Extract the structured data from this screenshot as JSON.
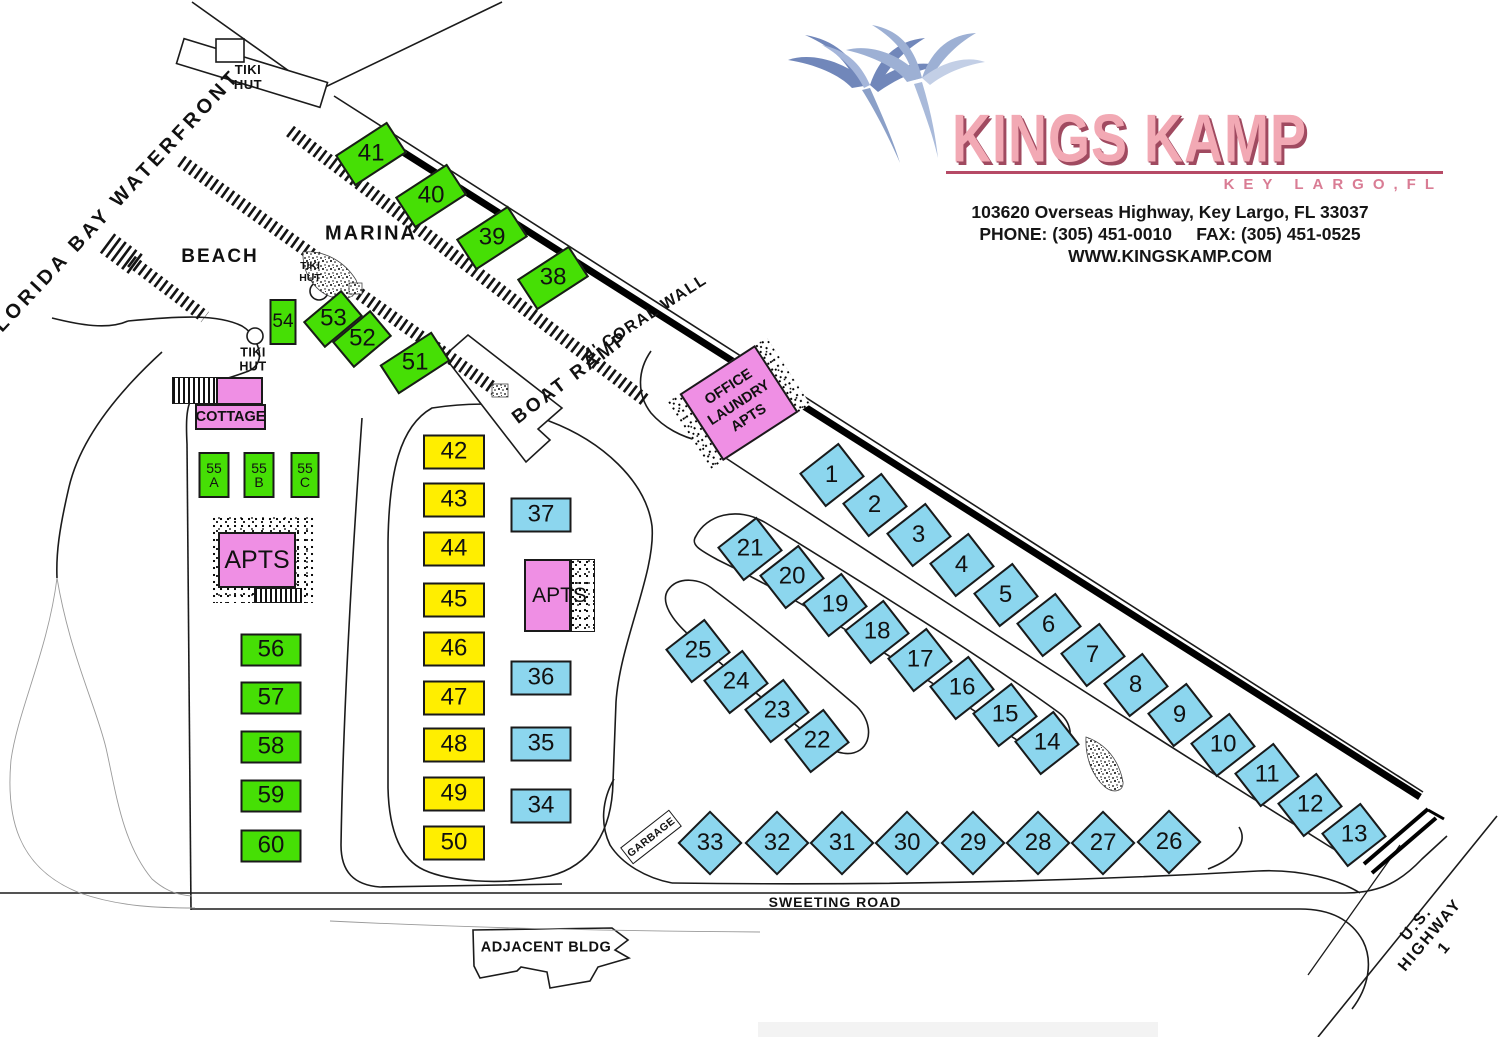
{
  "header": {
    "brand": "KINGS KAMP",
    "tagline": "KEY LARGO,FL",
    "address": "103620 Overseas Highway, Key Largo, FL 33037",
    "phone": "PHONE: (305) 451-0010",
    "fax": "FAX: (305) 451-0525",
    "website": "WWW.KINGSKAMP.COM"
  },
  "colors": {
    "site_green": "#46df05",
    "site_yellow": "#ffee00",
    "site_blue": "#8cd6ee",
    "building_pink": "#ef8fe4",
    "brand_pink": "#f2a9b4",
    "brand_shadow": "#a04a60"
  },
  "buildings": {
    "cottage": {
      "label": "COTTAGE"
    },
    "apartments_west": {
      "label": "APTS"
    },
    "apartments_center": {
      "label": "APTS"
    },
    "office": {
      "lines": [
        "OFFICE",
        "LAUNDRY",
        "APTS"
      ]
    },
    "garbage": {
      "label": "GARBAGE"
    }
  },
  "map": {
    "labels": [
      {
        "id": "florida-bay-waterfront",
        "text": "FLORIDA BAY WATERFRONT",
        "x": 112,
        "y": 207,
        "r": -47,
        "fs": 20,
        "ls": 4
      },
      {
        "id": "tiki-hut-north",
        "text": "TIKI\nHUT",
        "x": 248,
        "y": 78,
        "fs": 13,
        "ls": 0.5
      },
      {
        "id": "marina",
        "text": "MARINA",
        "x": 371,
        "y": 234,
        "fs": 20,
        "ls": 2
      },
      {
        "id": "beach",
        "text": "BEACH",
        "x": 220,
        "y": 257,
        "fs": 19,
        "ls": 2
      },
      {
        "id": "tiki-hut-marina",
        "text": "TIKI\nHUT",
        "x": 310,
        "y": 272,
        "fs": 10.5,
        "ls": 0
      },
      {
        "id": "tiki-hut-beach",
        "text": "TIKI\nHUT",
        "x": 253,
        "y": 360,
        "fs": 12.5,
        "ls": 0.5
      },
      {
        "id": "coral-wall",
        "text": "4' CORAL WALL",
        "x": 646,
        "y": 318,
        "r": -33,
        "fs": 16,
        "ls": 1.5
      },
      {
        "id": "boat-ramp",
        "text": "BOAT RAMP",
        "x": 571,
        "y": 378,
        "r": -37,
        "fs": 19,
        "ls": 3
      },
      {
        "id": "sweeting-road",
        "text": "SWEETING ROAD",
        "x": 835,
        "y": 902,
        "fs": 14,
        "ls": 1
      },
      {
        "id": "adjacent-bldg",
        "text": "ADJACENT BLDG",
        "x": 546,
        "y": 948,
        "fs": 14.5,
        "ls": 0.5
      },
      {
        "id": "us-highway-1",
        "text": "U.S. HIGHWAY 1",
        "x": 1431,
        "y": 936,
        "r": -50,
        "fs": 16,
        "ls": 2
      }
    ],
    "sites": [
      {
        "l": "1",
        "x": 832,
        "y": 475,
        "w": 50,
        "h": 43,
        "r": -38,
        "c": "blue"
      },
      {
        "l": "2",
        "x": 875,
        "y": 505,
        "w": 50,
        "h": 43,
        "r": -38,
        "c": "blue"
      },
      {
        "l": "3",
        "x": 919,
        "y": 535,
        "w": 50,
        "h": 43,
        "r": -38,
        "c": "blue"
      },
      {
        "l": "4",
        "x": 962,
        "y": 565,
        "w": 50,
        "h": 43,
        "r": -38,
        "c": "blue"
      },
      {
        "l": "5",
        "x": 1006,
        "y": 595,
        "w": 50,
        "h": 43,
        "r": -38,
        "c": "blue"
      },
      {
        "l": "6",
        "x": 1049,
        "y": 625,
        "w": 50,
        "h": 43,
        "r": -38,
        "c": "blue"
      },
      {
        "l": "7",
        "x": 1093,
        "y": 655,
        "w": 50,
        "h": 43,
        "r": -38,
        "c": "blue"
      },
      {
        "l": "8",
        "x": 1136,
        "y": 685,
        "w": 50,
        "h": 43,
        "r": -38,
        "c": "blue"
      },
      {
        "l": "9",
        "x": 1180,
        "y": 715,
        "w": 50,
        "h": 43,
        "r": -38,
        "c": "blue"
      },
      {
        "l": "10",
        "x": 1223,
        "y": 745,
        "w": 50,
        "h": 43,
        "r": -38,
        "c": "blue"
      },
      {
        "l": "11",
        "x": 1267,
        "y": 775,
        "w": 50,
        "h": 43,
        "r": -38,
        "c": "blue"
      },
      {
        "l": "12",
        "x": 1310,
        "y": 805,
        "w": 50,
        "h": 43,
        "r": -38,
        "c": "blue"
      },
      {
        "l": "13",
        "x": 1354,
        "y": 835,
        "w": 50,
        "h": 43,
        "r": -38,
        "c": "blue"
      },
      {
        "l": "14",
        "x": 1047,
        "y": 743,
        "w": 50,
        "h": 43,
        "r": -38,
        "c": "blue"
      },
      {
        "l": "15",
        "x": 1005,
        "y": 715,
        "w": 50,
        "h": 43,
        "r": -38,
        "c": "blue"
      },
      {
        "l": "16",
        "x": 962,
        "y": 688,
        "w": 50,
        "h": 43,
        "r": -38,
        "c": "blue"
      },
      {
        "l": "17",
        "x": 920,
        "y": 660,
        "w": 50,
        "h": 43,
        "r": -38,
        "c": "blue"
      },
      {
        "l": "18",
        "x": 877,
        "y": 632,
        "w": 50,
        "h": 43,
        "r": -38,
        "c": "blue"
      },
      {
        "l": "19",
        "x": 835,
        "y": 605,
        "w": 50,
        "h": 43,
        "r": -38,
        "c": "blue"
      },
      {
        "l": "20",
        "x": 792,
        "y": 577,
        "w": 50,
        "h": 43,
        "r": -38,
        "c": "blue"
      },
      {
        "l": "21",
        "x": 750,
        "y": 549,
        "w": 50,
        "h": 43,
        "r": -38,
        "c": "blue"
      },
      {
        "l": "22",
        "x": 817,
        "y": 741,
        "w": 50,
        "h": 43,
        "r": -38,
        "c": "blue"
      },
      {
        "l": "23",
        "x": 777,
        "y": 711,
        "w": 50,
        "h": 43,
        "r": -38,
        "c": "blue"
      },
      {
        "l": "24",
        "x": 736,
        "y": 682,
        "w": 50,
        "h": 43,
        "r": -38,
        "c": "blue"
      },
      {
        "l": "25",
        "x": 698,
        "y": 651,
        "w": 50,
        "h": 43,
        "r": -38,
        "c": "blue"
      },
      {
        "l": "26",
        "x": 1169,
        "y": 842,
        "w": 46,
        "h": 46,
        "r": 45,
        "c": "blue"
      },
      {
        "l": "27",
        "x": 1103,
        "y": 843,
        "w": 46,
        "h": 46,
        "r": 45,
        "c": "blue"
      },
      {
        "l": "28",
        "x": 1038,
        "y": 843,
        "w": 46,
        "h": 46,
        "r": 45,
        "c": "blue"
      },
      {
        "l": "29",
        "x": 973,
        "y": 843,
        "w": 46,
        "h": 46,
        "r": 45,
        "c": "blue"
      },
      {
        "l": "30",
        "x": 907,
        "y": 843,
        "w": 46,
        "h": 46,
        "r": 45,
        "c": "blue"
      },
      {
        "l": "31",
        "x": 842,
        "y": 843,
        "w": 46,
        "h": 46,
        "r": 45,
        "c": "blue"
      },
      {
        "l": "32",
        "x": 777,
        "y": 843,
        "w": 46,
        "h": 46,
        "r": 45,
        "c": "blue"
      },
      {
        "l": "33",
        "x": 710,
        "y": 843,
        "w": 46,
        "h": 46,
        "r": 45,
        "c": "blue"
      },
      {
        "l": "34",
        "x": 541,
        "y": 806,
        "w": 61,
        "h": 35,
        "r": 0,
        "c": "blue"
      },
      {
        "l": "35",
        "x": 541,
        "y": 744,
        "w": 61,
        "h": 35,
        "r": 0,
        "c": "blue"
      },
      {
        "l": "36",
        "x": 541,
        "y": 678,
        "w": 61,
        "h": 35,
        "r": 0,
        "c": "blue"
      },
      {
        "l": "37",
        "x": 541,
        "y": 515,
        "w": 61,
        "h": 35,
        "r": 0,
        "c": "blue"
      },
      {
        "l": "38",
        "x": 553,
        "y": 278,
        "w": 62,
        "h": 37,
        "r": -33,
        "c": "green"
      },
      {
        "l": "39",
        "x": 492,
        "y": 238,
        "w": 62,
        "h": 37,
        "r": -33,
        "c": "green"
      },
      {
        "l": "40",
        "x": 431,
        "y": 196,
        "w": 62,
        "h": 37,
        "r": -33,
        "c": "green"
      },
      {
        "l": "41",
        "x": 371,
        "y": 154,
        "w": 62,
        "h": 37,
        "r": -33,
        "c": "green"
      },
      {
        "l": "42",
        "x": 454,
        "y": 452,
        "w": 62,
        "h": 35,
        "r": 0,
        "c": "yellow"
      },
      {
        "l": "43",
        "x": 454,
        "y": 500,
        "w": 62,
        "h": 35,
        "r": 0,
        "c": "yellow"
      },
      {
        "l": "44",
        "x": 454,
        "y": 549,
        "w": 62,
        "h": 35,
        "r": 0,
        "c": "yellow"
      },
      {
        "l": "45",
        "x": 454,
        "y": 600,
        "w": 62,
        "h": 35,
        "r": 0,
        "c": "yellow"
      },
      {
        "l": "46",
        "x": 454,
        "y": 649,
        "w": 62,
        "h": 35,
        "r": 0,
        "c": "yellow"
      },
      {
        "l": "47",
        "x": 454,
        "y": 698,
        "w": 62,
        "h": 35,
        "r": 0,
        "c": "yellow"
      },
      {
        "l": "48",
        "x": 454,
        "y": 745,
        "w": 62,
        "h": 35,
        "r": 0,
        "c": "yellow"
      },
      {
        "l": "49",
        "x": 454,
        "y": 794,
        "w": 62,
        "h": 35,
        "r": 0,
        "c": "yellow"
      },
      {
        "l": "50",
        "x": 454,
        "y": 843,
        "w": 62,
        "h": 35,
        "r": 0,
        "c": "yellow"
      },
      {
        "l": "51",
        "x": 415,
        "y": 363,
        "w": 62,
        "h": 35,
        "r": -33,
        "c": "green"
      },
      {
        "l": "52",
        "x": 362,
        "y": 339,
        "w": 50,
        "h": 34,
        "r": -40,
        "c": "green"
      },
      {
        "l": "53",
        "x": 333,
        "y": 319,
        "w": 50,
        "h": 34,
        "r": -40,
        "c": "green"
      },
      {
        "l": "54",
        "x": 283,
        "y": 322,
        "w": 27,
        "h": 46,
        "r": 0,
        "c": "green",
        "fs": 19
      },
      {
        "l": "55\nA",
        "x": 214,
        "y": 475,
        "w": 31,
        "h": 46,
        "r": 0,
        "c": "green",
        "fs": 14
      },
      {
        "l": "55\nB",
        "x": 259,
        "y": 475,
        "w": 31,
        "h": 46,
        "r": 0,
        "c": "green",
        "fs": 14
      },
      {
        "l": "55\nC",
        "x": 305,
        "y": 475,
        "w": 29,
        "h": 46,
        "r": 0,
        "c": "green",
        "fs": 14
      },
      {
        "l": "56",
        "x": 271,
        "y": 650,
        "w": 61,
        "h": 33,
        "r": 0,
        "c": "green"
      },
      {
        "l": "57",
        "x": 271,
        "y": 698,
        "w": 61,
        "h": 33,
        "r": 0,
        "c": "green"
      },
      {
        "l": "58",
        "x": 271,
        "y": 747,
        "w": 61,
        "h": 33,
        "r": 0,
        "c": "green"
      },
      {
        "l": "59",
        "x": 271,
        "y": 796,
        "w": 61,
        "h": 33,
        "r": 0,
        "c": "green"
      },
      {
        "l": "60",
        "x": 271,
        "y": 846,
        "w": 61,
        "h": 33,
        "r": 0,
        "c": "green"
      }
    ]
  }
}
